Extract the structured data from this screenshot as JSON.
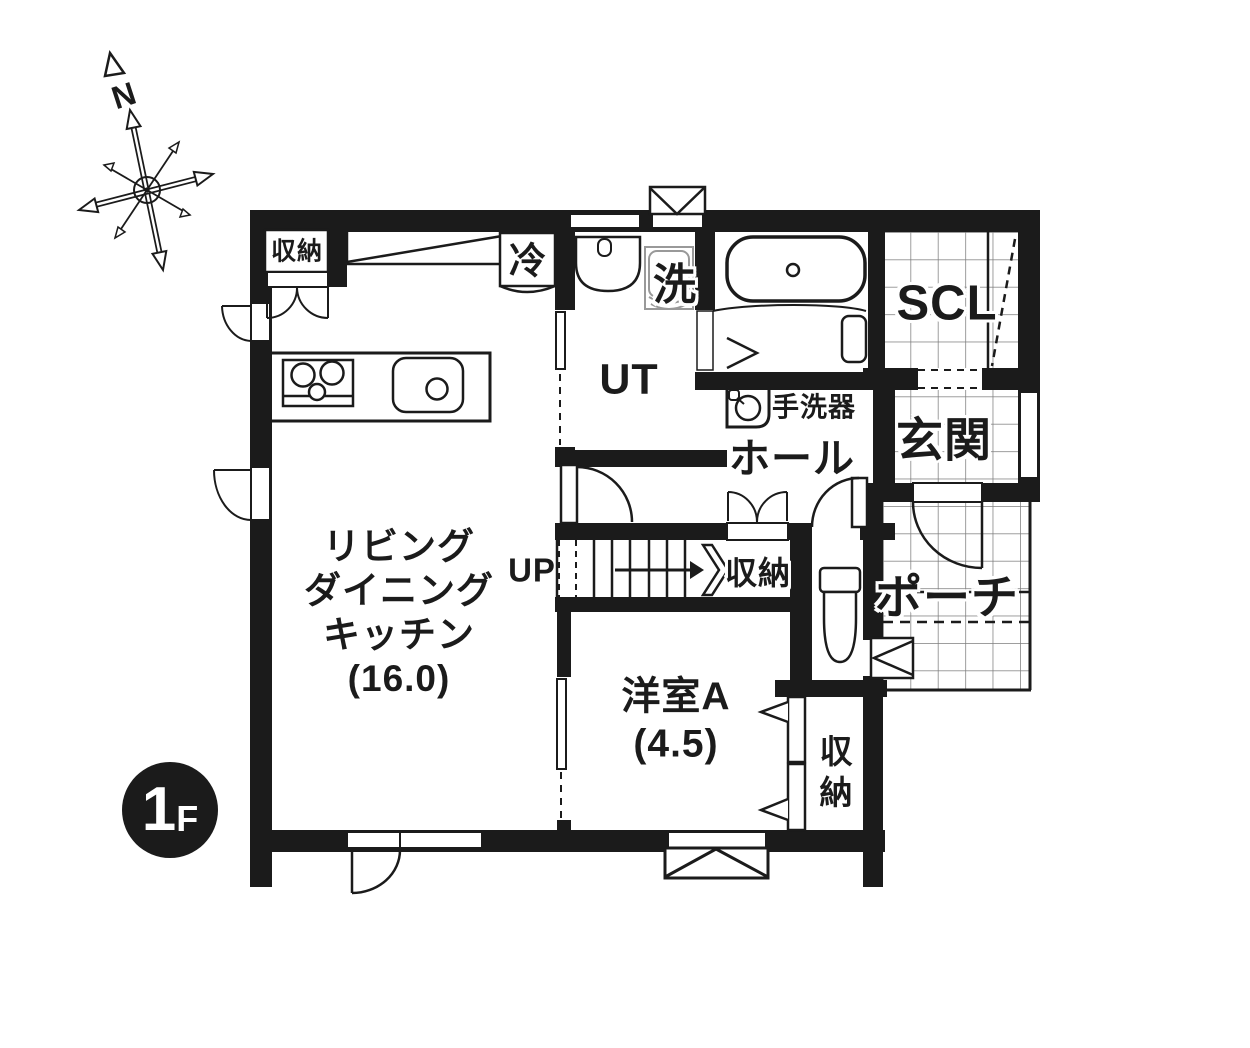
{
  "badge": {
    "number": "1",
    "suffix": "F"
  },
  "compass": {
    "north": "N"
  },
  "labels": {
    "ldk": {
      "line1": "リビング",
      "line2": "ダイニング",
      "line3": "キッチン",
      "area": "(16.0)"
    },
    "western_room_a": {
      "name": "洋室A",
      "area": "(4.5)"
    },
    "utility": "UT",
    "shoe_closet": "SCL",
    "entrance": "玄関",
    "hall": "ホール",
    "porch": "ポーチ",
    "washer": "洗",
    "refrigerator": "冷",
    "stairs_up": "UP",
    "hand_wash": "手洗器",
    "storage_ldk": "収納",
    "storage_stairs": "収納",
    "storage_western_room": "収納"
  },
  "colors": {
    "wall": "#1b1b1b",
    "grid_line": "#7d7d7d",
    "fixture_gray": "#999999",
    "background": "#ffffff"
  }
}
